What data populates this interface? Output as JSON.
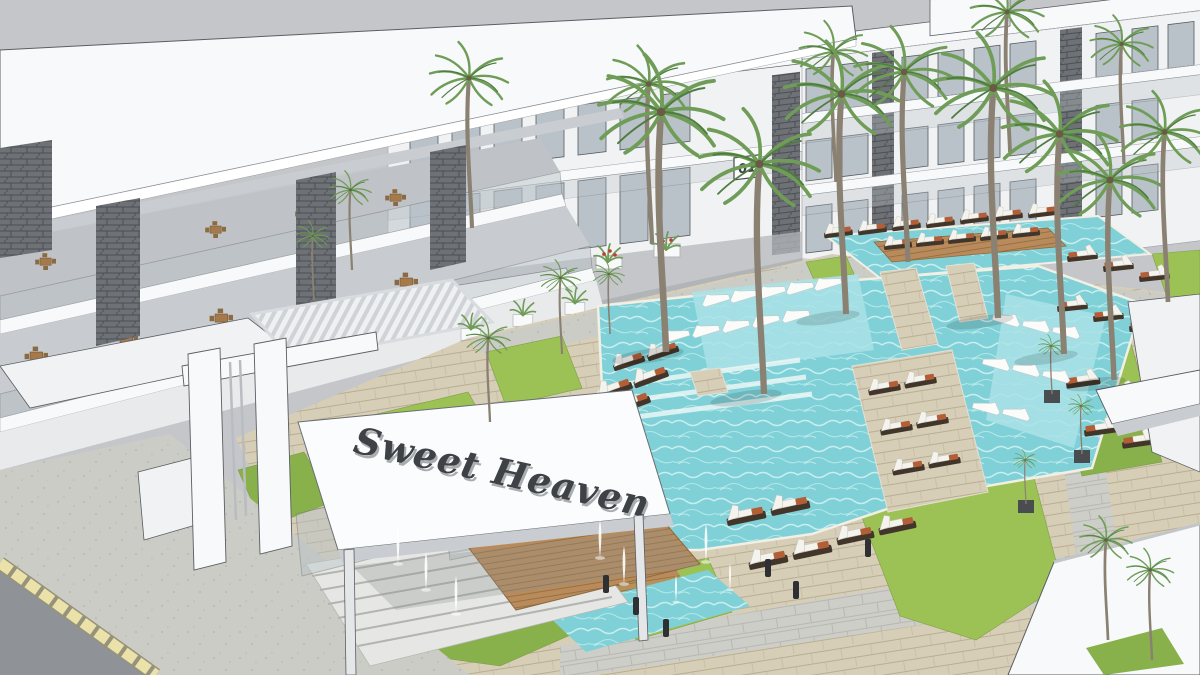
{
  "scene": {
    "description": "3D architectural rendering of the Sweet Heaven resort: white modern apartment blocks around a turquoise courtyard pool with timber decks, lawns, palm trees, sun loungers, an entrance portal with a signed canopy, fountain jets, stairs and a street corner",
    "entrance_sign": {
      "text": "Sweet Heaven"
    },
    "block_plaque": {
      "text": "01"
    },
    "palette": {
      "sky": "#c4c6ca",
      "wall": "#f1f2f4",
      "wall2": "#e4e6e8",
      "roofwhite": "#f8f9fa",
      "shade": "#c9ccd0",
      "shade2": "#b4b7bb",
      "line": "#5a5e63",
      "glass": "#b9c2c8",
      "glass2": "#8f979e",
      "stone": "#6e7175",
      "water": "#7fd1d7",
      "water2": "#a9e2e6",
      "deck": "#d7ceb8",
      "deck2": "#b9ae94",
      "wood": "#b98b5c",
      "wood2": "#97713f",
      "grass": "#9cc256",
      "grass2": "#88b04b",
      "paver": "#cdcec8",
      "paver2": "#b7b8b1",
      "road": "#8f9296",
      "curb": "#eae2a9",
      "cushion": "#f4f3ee",
      "frame": "#42362b",
      "accent": "#b45e37",
      "palm": "#6f9d58",
      "palm2": "#4e7c41",
      "trunk": "#8b8173",
      "bollard": "#2e3033",
      "flower": "#c33b2e",
      "signtext": "#3e4145"
    }
  }
}
